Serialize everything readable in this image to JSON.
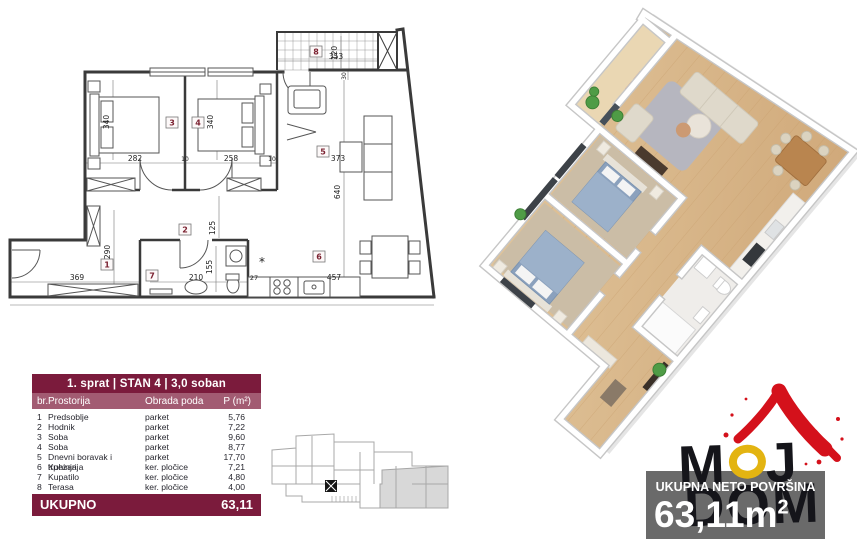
{
  "table": {
    "title": "1. sprat | STAN 4 | 3,0 soban",
    "columns": {
      "num": "br.",
      "room": "Prostorija",
      "floor": "Obrada poda",
      "area": "P (m²)"
    },
    "rows": [
      {
        "num": "1",
        "room": "Predsoblje",
        "floor": "parket",
        "area": "5,76"
      },
      {
        "num": "2",
        "room": "Hodnik",
        "floor": "parket",
        "area": "7,22"
      },
      {
        "num": "3",
        "room": "Soba",
        "floor": "parket",
        "area": "9,60"
      },
      {
        "num": "4",
        "room": "Soba",
        "floor": "parket",
        "area": "8,77"
      },
      {
        "num": "5",
        "room": "Dnevni boravak i trpezarija",
        "floor": "parket",
        "area": "17,70"
      },
      {
        "num": "6",
        "room": "Kuhinja",
        "floor": "ker. pločice",
        "area": "7,21"
      },
      {
        "num": "7",
        "room": "Kupatilo",
        "floor": "ker. pločice",
        "area": "4,80"
      },
      {
        "num": "8",
        "room": "Terasa",
        "floor": "ker. pločice",
        "area": "4,00"
      }
    ],
    "total": {
      "label": "UKUPNO",
      "value": "63,11"
    }
  },
  "summary": {
    "label": "UKUPNA NETO POVRŠINA",
    "value": "63,11m",
    "sup": "2"
  },
  "logo": {
    "m": "M",
    "o": "O",
    "j": "J",
    "bottom": "DOM"
  },
  "plan2d": {
    "rooms": [
      "1",
      "2",
      "3",
      "4",
      "5",
      "6",
      "7",
      "8"
    ],
    "dims": [
      "340",
      "282",
      "340",
      "258",
      "373",
      "640",
      "353",
      "120",
      "30",
      "290",
      "369",
      "125",
      "155",
      "210",
      "27",
      "457",
      "10",
      "10"
    ],
    "symbol_boiler": "*"
  },
  "colors": {
    "maroon": "#7b1b3c",
    "maroon_light": "#a25b72",
    "logo_red": "#d4111b",
    "logo_yellow": "#e3b411",
    "box_gray": "#6a6a6a"
  }
}
